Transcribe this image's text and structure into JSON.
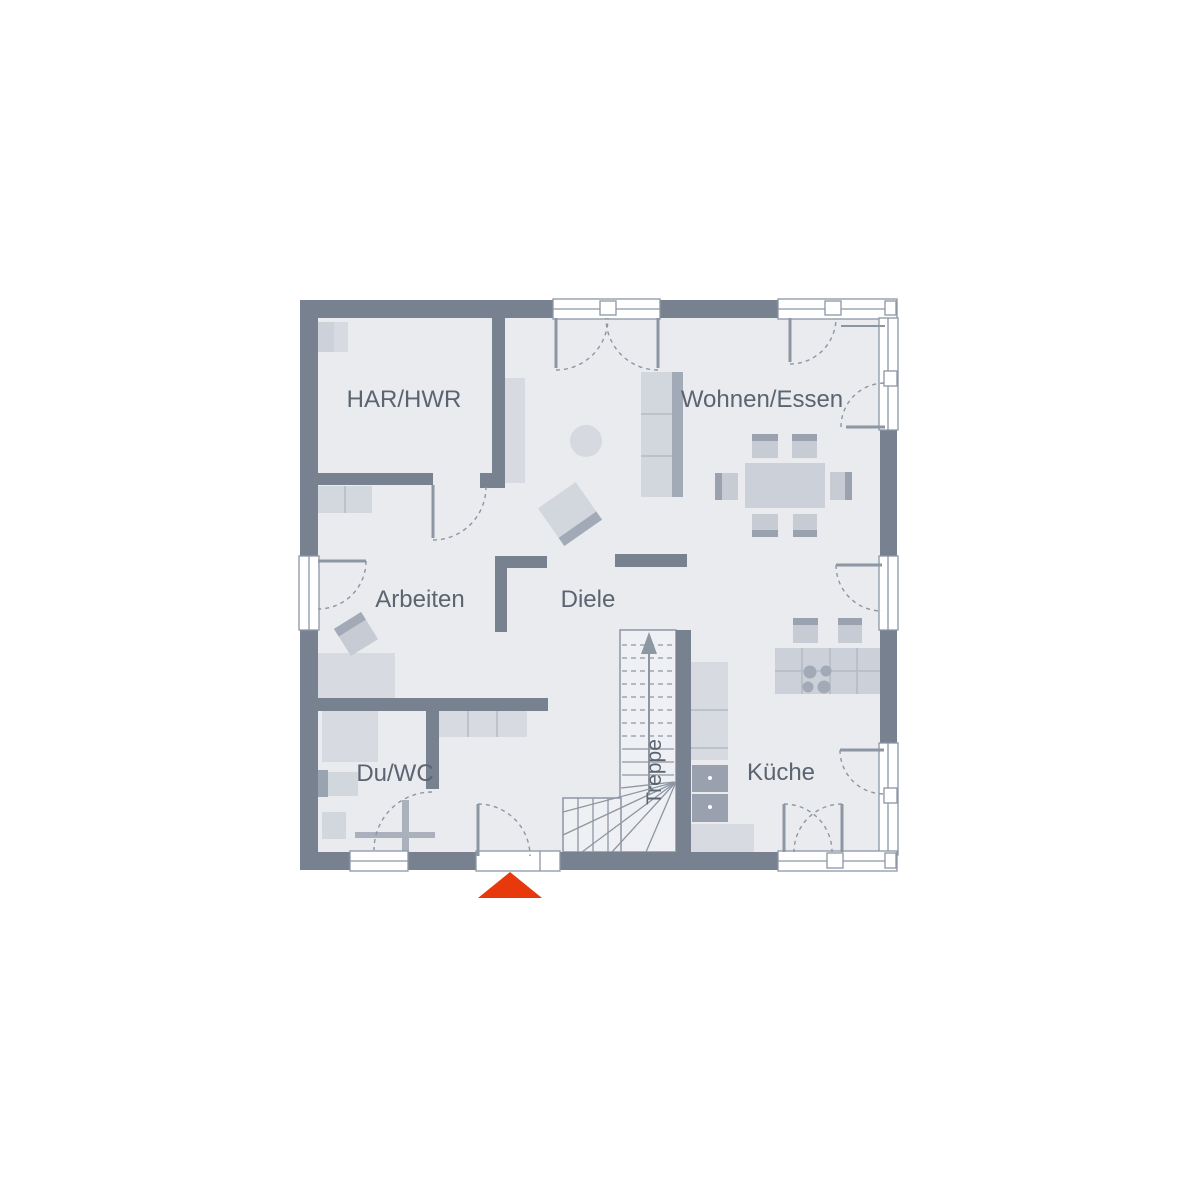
{
  "plan": {
    "title": "floor-plan-ground-floor",
    "rooms": {
      "har_hwr": {
        "label": "HAR/HWR"
      },
      "wohnen_essen": {
        "label": "Wohnen/Essen"
      },
      "arbeiten": {
        "label": "Arbeiten"
      },
      "diele": {
        "label": "Diele"
      },
      "du_wc": {
        "label": "Du/WC"
      },
      "treppe": {
        "label": "Treppe"
      },
      "kueche": {
        "label": "Küche"
      }
    },
    "stairs": {
      "direction": "up"
    },
    "entrance_marker": {
      "shape": "triangle-up",
      "color": "#e8390c"
    },
    "colors": {
      "wall": "#77818f",
      "floor": "#e9ebef",
      "furniture_light": "#d7dae1",
      "furniture_mid": "#c6cbd4",
      "furniture_dark": "#a2aab7",
      "appliance": "#99a1ae",
      "line": "#8d96a3",
      "label_text": "#5b6470",
      "window": "#ffffff"
    }
  }
}
